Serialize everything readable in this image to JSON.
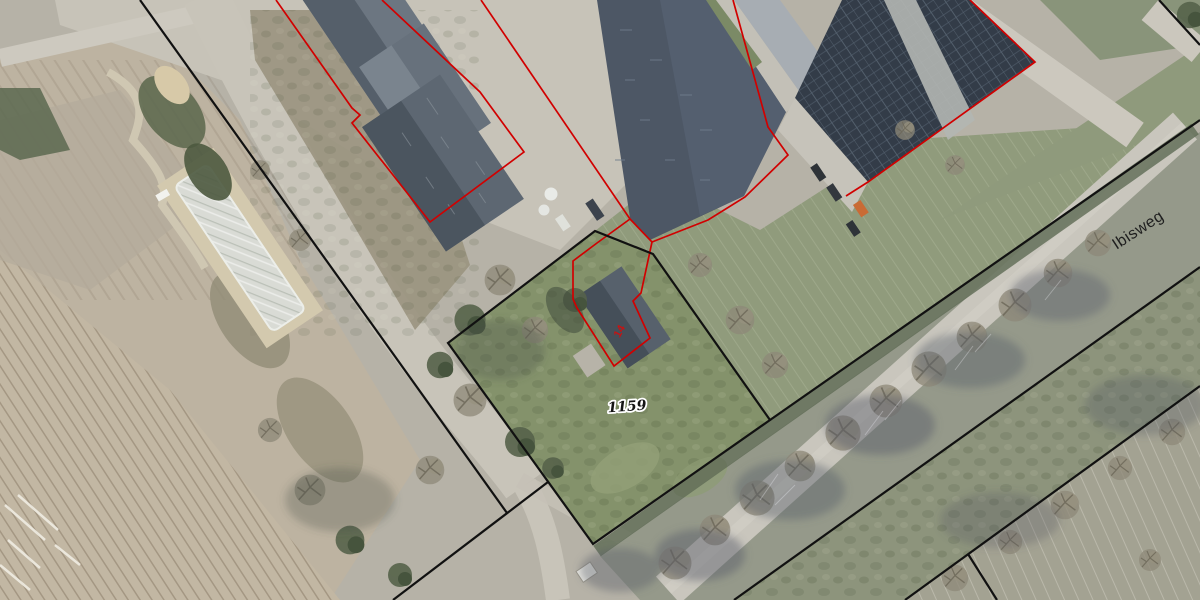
{
  "map": {
    "type": "aerial-cadastral-view",
    "labels": {
      "parcel_number": "1159",
      "house_number": "14",
      "street_name": "Ibisweg"
    },
    "colors": {
      "cadastral_boundary": "#111111",
      "building_outline": "#d10000",
      "parcel_label_fill": "#141414",
      "street_label_fill": "#1f1f1f",
      "house_number_fill": "#c41414",
      "grass": "#84926b",
      "field": "#c2b7a3",
      "road": "#c9c6bd",
      "roof_dark": "#4d5765",
      "solar_panels": "#333c48"
    },
    "features": [
      "plowed-field",
      "farm-yard",
      "barn-roofs",
      "industrial-hall-roof",
      "solar-panel-roof",
      "polytunnel",
      "grass-parcel",
      "bare-tree-row",
      "street-ibisweg",
      "ditch",
      "parcel-boundaries",
      "building-outlines"
    ]
  }
}
